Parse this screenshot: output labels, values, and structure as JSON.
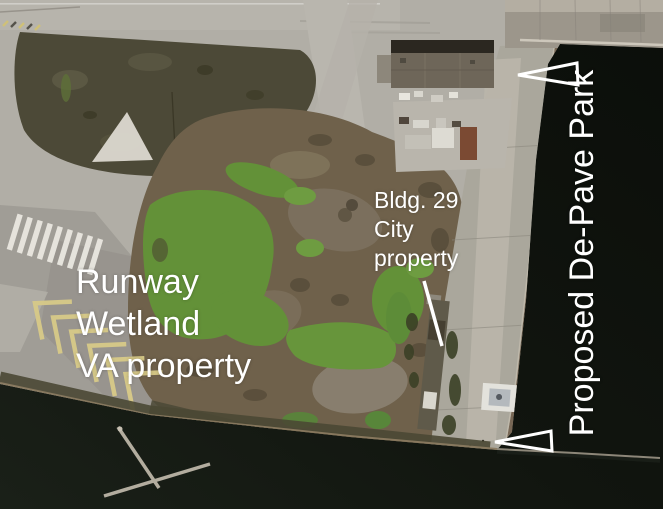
{
  "canvas": {
    "width": 663,
    "height": 509
  },
  "annotations": {
    "runway_wetland": {
      "lines": [
        "Runway",
        "Wetland",
        "VA property"
      ]
    },
    "bldg29": {
      "lines": [
        "Bldg. 29",
        "City",
        "property"
      ]
    },
    "depave_park": {
      "label": "Proposed De-Pave Park"
    }
  },
  "markers": {
    "top_arrow": {
      "icon": "triangle-outline-left-arrow",
      "points": "518,75 577,63 578,85"
    },
    "bottom_arrow": {
      "icon": "triangle-outline-left-arrow",
      "points": "495,442 551,431 552,451"
    },
    "leader_line": {
      "icon": "leader-line"
    }
  },
  "colors": {
    "annotation_text": "#ffffff",
    "water": "#10140e",
    "tarmac": "#b1aea6",
    "wetland_green": "#639138",
    "wetland_brown": "#6f614b",
    "scrub": "#4c4937",
    "runway_marking_yellow": "#d8ca88"
  }
}
